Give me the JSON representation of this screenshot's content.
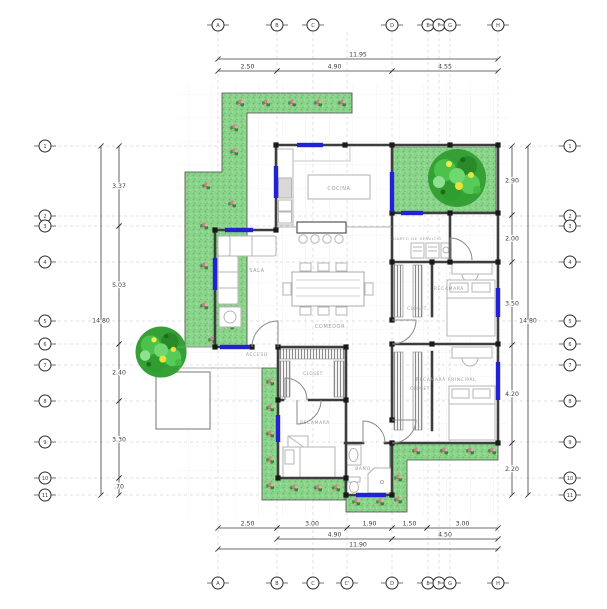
{
  "colors": {
    "window_accent": "#2321d6",
    "wall": "#3d3d3d",
    "garden_green": "#8bd48b",
    "tree_green": "#35a035",
    "flower_pink": "#c9848f",
    "label_gray": "#9b9b9b",
    "dimension_text": "#3c3c3c"
  },
  "rooms": {
    "cocina": "COCINA",
    "sala": "SALA",
    "comedor": "COMEDOR",
    "acceso": "ACCESO",
    "cuarto_servicio": "CUARTO DE SERVICIO",
    "closet_entry": "CLOSET",
    "recamara2": "RECAMARÁ",
    "closet2": "CLOSET",
    "recamara_principal": "RECAMARÁ PRINCIPAL",
    "closet_principal": "CLOSET",
    "recamara3": "RECAMARÁ",
    "bano": "BAÑO"
  },
  "grid": {
    "top": {
      "y": 25,
      "markers": [
        {
          "label": "A",
          "x": 218
        },
        {
          "label": "B",
          "x": 277
        },
        {
          "label": "C",
          "x": 313
        },
        {
          "label": "D",
          "x": 392
        },
        {
          "label": "E",
          "x": 428
        },
        {
          "label": "F",
          "x": 439
        },
        {
          "label": "G",
          "x": 450
        },
        {
          "label": "H",
          "x": 498
        }
      ]
    },
    "bottom": {
      "y": 583,
      "markers": [
        {
          "label": "A",
          "x": 218
        },
        {
          "label": "B",
          "x": 277
        },
        {
          "label": "C",
          "x": 313
        },
        {
          "label": "C'",
          "x": 347
        },
        {
          "label": "D",
          "x": 392
        },
        {
          "label": "E",
          "x": 428
        },
        {
          "label": "F",
          "x": 439
        },
        {
          "label": "G",
          "x": 450
        },
        {
          "label": "H",
          "x": 498
        }
      ]
    },
    "left": {
      "x": 45,
      "markers": [
        {
          "label": "1",
          "y": 146
        },
        {
          "label": "2",
          "y": 216
        },
        {
          "label": "3",
          "y": 226
        },
        {
          "label": "4",
          "y": 262
        },
        {
          "label": "5",
          "y": 321
        },
        {
          "label": "6",
          "y": 344
        },
        {
          "label": "7",
          "y": 365
        },
        {
          "label": "8",
          "y": 401
        },
        {
          "label": "9",
          "y": 442
        },
        {
          "label": "10",
          "y": 478
        },
        {
          "label": "11",
          "y": 495
        }
      ]
    },
    "right": {
      "x": 570,
      "markers": [
        {
          "label": "1",
          "y": 146
        },
        {
          "label": "2",
          "y": 216
        },
        {
          "label": "3",
          "y": 226
        },
        {
          "label": "4",
          "y": 262
        },
        {
          "label": "5",
          "y": 321
        },
        {
          "label": "6",
          "y": 344
        },
        {
          "label": "7",
          "y": 365
        },
        {
          "label": "8",
          "y": 401
        },
        {
          "label": "9",
          "y": 442
        },
        {
          "label": "10",
          "y": 478
        },
        {
          "label": "11",
          "y": 495
        }
      ]
    }
  },
  "dims": {
    "top": [
      {
        "v": "11.95",
        "x1": 218,
        "x2": 498,
        "y": 59
      },
      {
        "v": "2.50",
        "x1": 218,
        "x2": 277,
        "y": 71
      },
      {
        "v": "4.90",
        "x1": 277,
        "x2": 392,
        "y": 71
      },
      {
        "v": "4.55",
        "x1": 392,
        "x2": 498,
        "y": 71
      }
    ],
    "bottom": [
      {
        "v": "2.50",
        "x1": 218,
        "x2": 277,
        "y": 528
      },
      {
        "v": "3.00",
        "x1": 277,
        "x2": 347,
        "y": 528
      },
      {
        "v": "1.90",
        "x1": 347,
        "x2": 392,
        "y": 528
      },
      {
        "v": "1.50",
        "x1": 392,
        "x2": 427,
        "y": 528
      },
      {
        "v": "3.00",
        "x1": 427,
        "x2": 498,
        "y": 528
      },
      {
        "v": "4.90",
        "x1": 277,
        "x2": 392,
        "y": 539
      },
      {
        "v": "4.50",
        "x1": 392,
        "x2": 498,
        "y": 539
      },
      {
        "v": "11.90",
        "x1": 218,
        "x2": 498,
        "y": 549
      }
    ],
    "left": [
      {
        "v": "14.80",
        "y1": 146,
        "y2": 495,
        "x": 101
      },
      {
        "v": "3.37",
        "y1": 146,
        "y2": 226,
        "x": 119
      },
      {
        "v": "5.03",
        "y1": 226,
        "y2": 344,
        "x": 119
      },
      {
        "v": "2.40",
        "y1": 344,
        "y2": 401,
        "x": 119
      },
      {
        "v": "3.30",
        "y1": 401,
        "y2": 478,
        "x": 119
      },
      {
        "v": ".70",
        "y1": 478,
        "y2": 495,
        "x": 119
      }
    ],
    "right": [
      {
        "v": "2.90",
        "y1": 146,
        "y2": 215,
        "x": 512
      },
      {
        "v": "2.00",
        "y1": 215,
        "y2": 262,
        "x": 512
      },
      {
        "v": "3.50",
        "y1": 262,
        "y2": 345,
        "x": 512
      },
      {
        "v": "4.20",
        "y1": 345,
        "y2": 443,
        "x": 512
      },
      {
        "v": "2.20",
        "y1": 443,
        "y2": 495,
        "x": 512
      },
      {
        "v": "14.80",
        "y1": 146,
        "y2": 495,
        "x": 528
      }
    ]
  }
}
